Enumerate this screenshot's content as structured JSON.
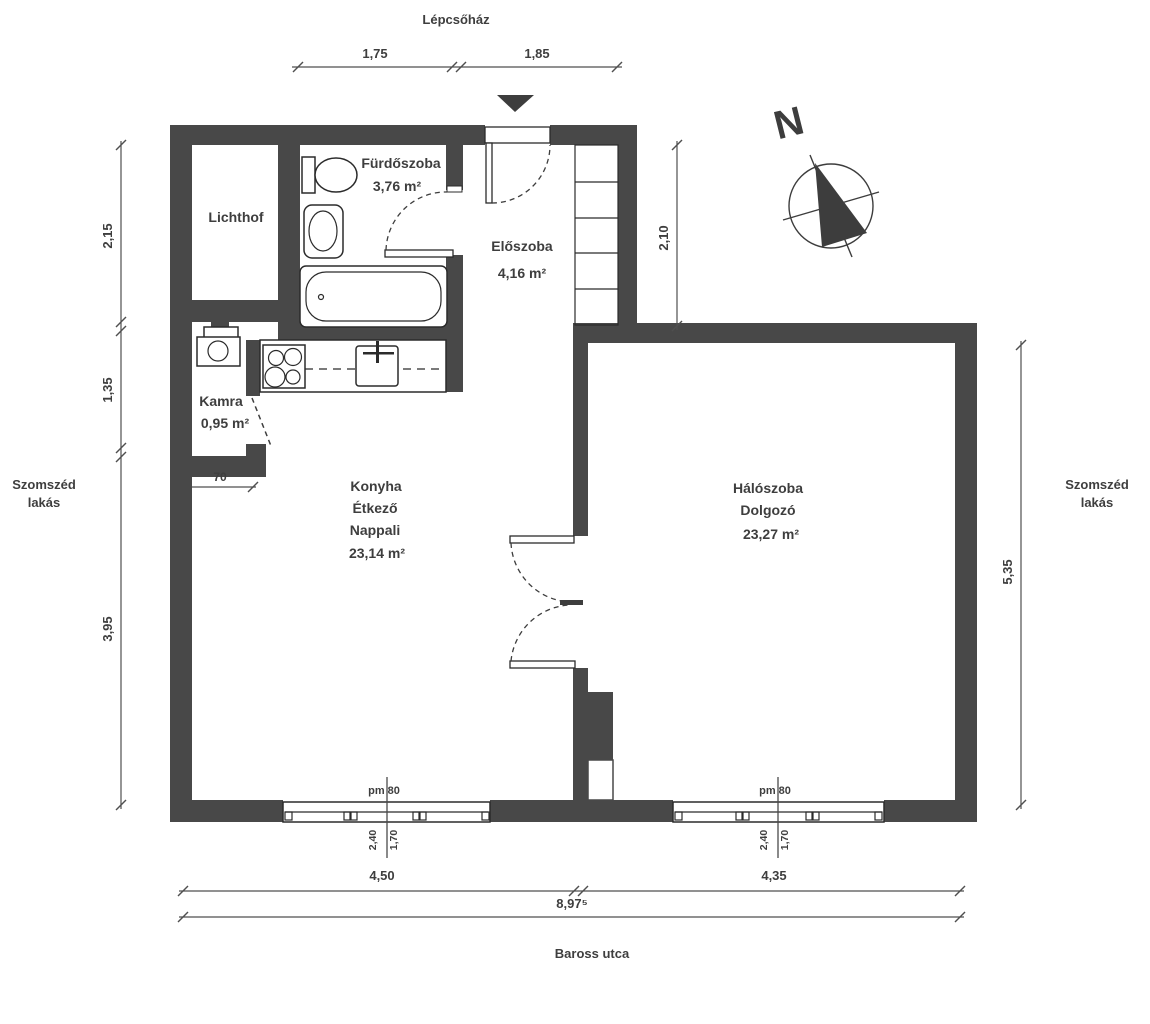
{
  "labels": {
    "lepcsohaz": "Lépcsőház",
    "baross_utca": "Baross utca",
    "szomszed1": "Szomszéd",
    "szomszed2": "lakás",
    "north": "N"
  },
  "rooms": {
    "lichthof": {
      "name": "Lichthof"
    },
    "furdoszoba": {
      "name": "Fürdőszoba",
      "area": "3,76 m²"
    },
    "eloszoba": {
      "name": "Előszoba",
      "area": "4,16 m²"
    },
    "kamra": {
      "name": "Kamra",
      "area": "0,95 m²"
    },
    "nappali": {
      "name1": "Konyha",
      "name2": "Étkező",
      "name3": "Nappali",
      "area": "23,14 m²"
    },
    "haloszoba": {
      "name1": "Hálószoba",
      "name2": "Dolgozó",
      "area": "23,27 m²"
    }
  },
  "dims": {
    "top1": "1,75",
    "top2": "1,85",
    "left1": "2,15",
    "left2": "1,35",
    "left3": "3,95",
    "right_top": "2,10",
    "right_bottom": "5,35",
    "bottom1": "4,50",
    "bottom2": "4,35",
    "total": "8,97⁵",
    "kamra_w": "70",
    "window_sill": "pm 80",
    "window_w": "2,40",
    "window_h": "1,70"
  },
  "colors": {
    "wall": "#484848",
    "line": "#4f4f4f",
    "text": "#3e3e3e"
  }
}
